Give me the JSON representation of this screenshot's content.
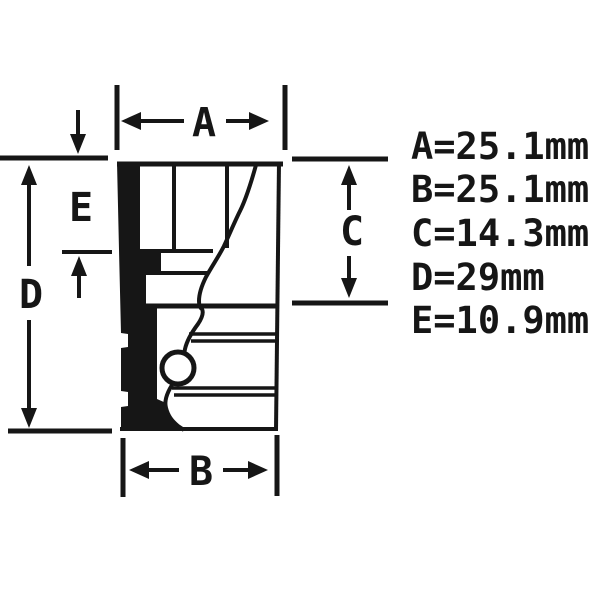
{
  "colors": {
    "ink": "#161616",
    "background": "#ffffff"
  },
  "diagram": {
    "unit": "mm",
    "dims": {
      "A": {
        "label": "A",
        "spec": "A=25.1mm",
        "value_mm": 25.1
      },
      "B": {
        "label": "B",
        "spec": "B=25.1mm",
        "value_mm": 25.1
      },
      "C": {
        "label": "C",
        "spec": "C=14.3mm",
        "value_mm": 14.3
      },
      "D": {
        "label": "D",
        "spec": "D=29mm",
        "value_mm": 29
      },
      "E": {
        "label": "E",
        "spec": "E=10.9mm",
        "value_mm": 10.9
      }
    }
  }
}
